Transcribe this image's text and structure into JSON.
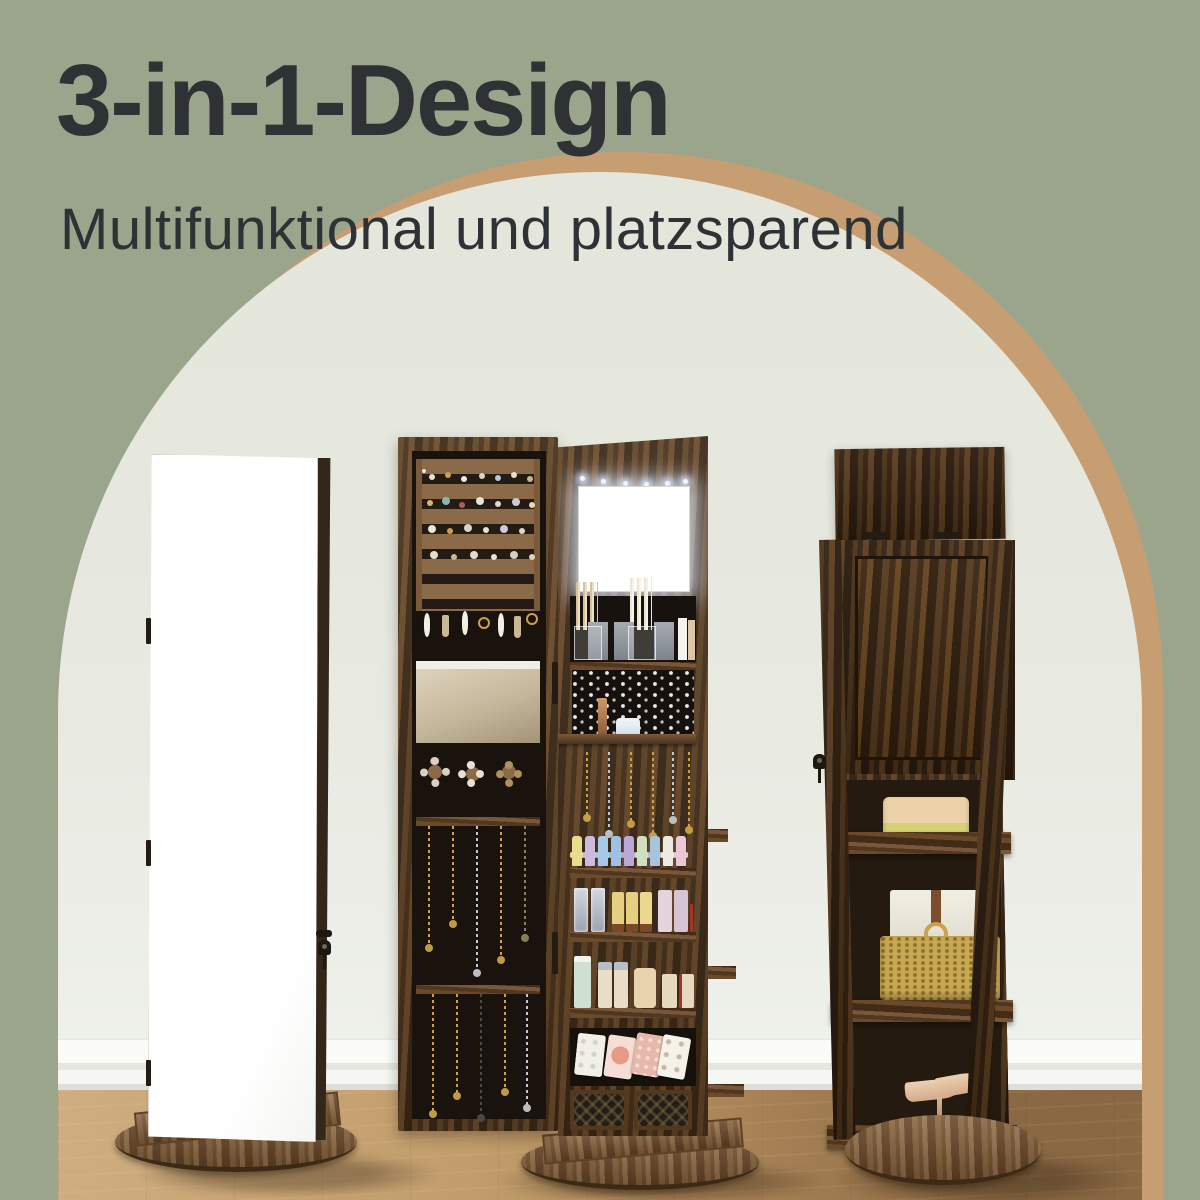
{
  "banner": {
    "title": "3-in-1-Design",
    "subtitle": "Multifunktional und platzsparend"
  },
  "colors": {
    "bg": "#9aa58c",
    "archfill": "#e6e8de",
    "ring": "#c79e72",
    "ink": "#2e3234",
    "floorlight": "#cfad80",
    "floordark": "#8a6843",
    "mirrorwhite": "#ffffff"
  }
}
